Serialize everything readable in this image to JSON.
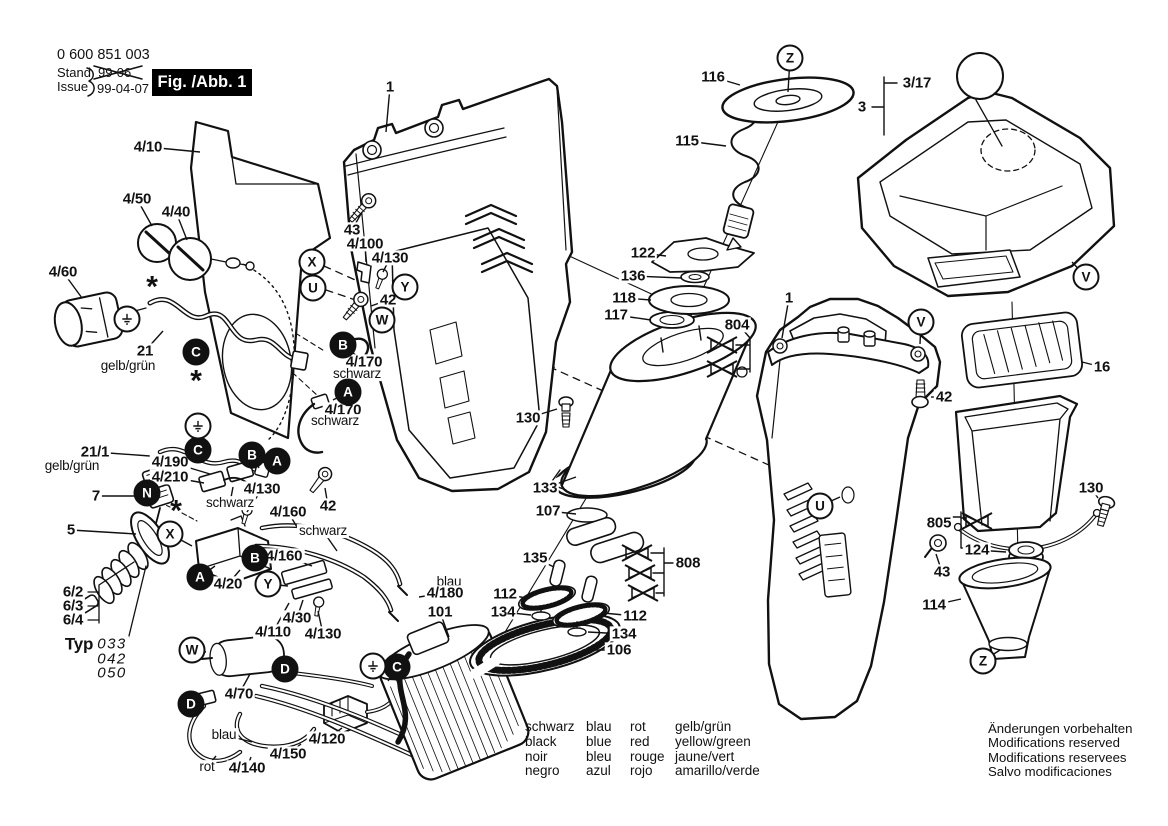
{
  "doc": {
    "part_number": "0 600 851 003",
    "stand_label": "Stand",
    "issue_label": "Issue",
    "old_issue": "99-06",
    "issue_date": "99-04-07",
    "figure_label": "Fig. /Abb. 1",
    "notice_lines": [
      "Änderungen vorbehalten",
      "Modifications reserved",
      "Modifications reservees",
      "Salvo modificaciones"
    ]
  },
  "color_legend": {
    "columns": [
      [
        "schwarz",
        "black",
        "noir",
        "negro"
      ],
      [
        "blau",
        "blue",
        "bleu",
        "azul"
      ],
      [
        "rot",
        "red",
        "rouge",
        "rojo"
      ],
      [
        "gelb/grün",
        "yellow/green",
        "jaune/vert",
        "amarillo/verde"
      ]
    ]
  },
  "colors": {
    "ink": "#111111",
    "paper": "#ffffff"
  },
  "part_labels": [
    {
      "t": "4/10",
      "x": 148,
      "y": 147,
      "tx": 200,
      "ty": 152
    },
    {
      "t": "4/50",
      "x": 137,
      "y": 199,
      "tx": 152,
      "ty": 226
    },
    {
      "t": "4/40",
      "x": 176,
      "y": 212,
      "tx": 187,
      "ty": 240
    },
    {
      "t": "4/60",
      "x": 63,
      "y": 272,
      "tx": 82,
      "ty": 298
    },
    {
      "t": "21",
      "x": 145,
      "y": 351,
      "tx": 163,
      "ty": 331
    },
    {
      "t": "gelb/grün",
      "x": 128,
      "y": 366,
      "b": 0
    },
    {
      "t": "21/1",
      "x": 95,
      "y": 452,
      "tx": 150,
      "ty": 456
    },
    {
      "t": "gelb/grün",
      "x": 72,
      "y": 466,
      "b": 0
    },
    {
      "t": "7",
      "x": 96,
      "y": 496,
      "tx": 146,
      "ty": 496
    },
    {
      "t": "5",
      "x": 71,
      "y": 530,
      "tx": 136,
      "ty": 534
    },
    {
      "t": "6/2",
      "x": 73,
      "y": 592
    },
    {
      "t": "6/3",
      "x": 73,
      "y": 606
    },
    {
      "t": "6/4",
      "x": 73,
      "y": 620
    },
    {
      "t": "Typ",
      "x": 79,
      "y": 644,
      "s": 17
    },
    {
      "t": "033",
      "x": 112,
      "y": 644,
      "i": 1
    },
    {
      "t": "042",
      "x": 112,
      "y": 659,
      "i": 1
    },
    {
      "t": "050",
      "x": 112,
      "y": 673,
      "i": 1
    },
    {
      "t": "4/190",
      "x": 170,
      "y": 462,
      "tx": 210,
      "ty": 474
    },
    {
      "t": "4/210",
      "x": 170,
      "y": 477,
      "tx": 204,
      "ty": 483
    },
    {
      "t": "schwarz",
      "x": 230,
      "y": 503,
      "b": 0,
      "tx": 233,
      "ty": 487
    },
    {
      "t": "4/130",
      "x": 262,
      "y": 489,
      "tx": 247,
      "ty": 512
    },
    {
      "t": "4/160",
      "x": 288,
      "y": 512,
      "tx": 300,
      "ty": 532
    },
    {
      "t": "schwarz",
      "x": 323,
      "y": 531,
      "b": 0,
      "tx": 337,
      "ty": 551
    },
    {
      "t": "4/160",
      "x": 284,
      "y": 556,
      "tx": 312,
      "ty": 566
    },
    {
      "t": "4/20",
      "x": 228,
      "y": 584,
      "tx": 240,
      "ty": 570
    },
    {
      "t": "4/30",
      "x": 297,
      "y": 618,
      "tx": 303,
      "ty": 600
    },
    {
      "t": "4/110",
      "x": 273,
      "y": 632,
      "tx": 289,
      "ty": 603
    },
    {
      "t": "4/130",
      "x": 323,
      "y": 634,
      "tx": 318,
      "ty": 611
    },
    {
      "t": "4/70",
      "x": 239,
      "y": 694,
      "tx": 250,
      "ty": 674
    },
    {
      "t": "blau",
      "x": 224,
      "y": 735,
      "b": 0,
      "tx": 252,
      "ty": 742
    },
    {
      "t": "4/120",
      "x": 327,
      "y": 739,
      "tx": 342,
      "ty": 728
    },
    {
      "t": "4/150",
      "x": 288,
      "y": 754,
      "tx": 301,
      "ty": 744
    },
    {
      "t": "rot",
      "x": 207,
      "y": 767,
      "b": 0,
      "tx": 216,
      "ty": 756
    },
    {
      "t": "4/140",
      "x": 247,
      "y": 768,
      "tx": 251,
      "ty": 757
    },
    {
      "t": "43",
      "x": 352,
      "y": 230,
      "tx": 362,
      "ty": 212
    },
    {
      "t": "4/100",
      "x": 365,
      "y": 244,
      "tx": 366,
      "ty": 262
    },
    {
      "t": "4/130",
      "x": 390,
      "y": 258,
      "tx": 383,
      "ty": 272
    },
    {
      "t": "42",
      "x": 388,
      "y": 300,
      "tx": 371,
      "ty": 306
    },
    {
      "t": "4/170",
      "x": 364,
      "y": 362,
      "tx": 352,
      "ty": 352
    },
    {
      "t": "schwarz",
      "x": 357,
      "y": 374,
      "b": 0
    },
    {
      "t": "4/170",
      "x": 343,
      "y": 410,
      "tx": 324,
      "ty": 403
    },
    {
      "t": "schwarz",
      "x": 335,
      "y": 421,
      "b": 0
    },
    {
      "t": "42",
      "x": 328,
      "y": 506,
      "tx": 325,
      "ty": 488
    },
    {
      "t": "1",
      "x": 390,
      "y": 87,
      "tx": 386,
      "ty": 132
    },
    {
      "t": "130",
      "x": 528,
      "y": 418,
      "tx": 557,
      "ty": 409
    },
    {
      "t": "133",
      "x": 545,
      "y": 488,
      "tx": 576,
      "ty": 477
    },
    {
      "t": "107",
      "x": 548,
      "y": 511,
      "tx": 576,
      "ty": 514
    },
    {
      "t": "135",
      "x": 535,
      "y": 558,
      "tx": 554,
      "ty": 567
    },
    {
      "t": "112",
      "x": 505,
      "y": 594,
      "tx": 526,
      "ty": 598
    },
    {
      "t": "134",
      "x": 503,
      "y": 612,
      "tx": 531,
      "ty": 615
    },
    {
      "t": "112",
      "x": 635,
      "y": 616,
      "tx": 603,
      "ty": 613
    },
    {
      "t": "134",
      "x": 624,
      "y": 634,
      "tx": 588,
      "ty": 632
    },
    {
      "t": "106",
      "x": 619,
      "y": 650,
      "tx": 594,
      "ty": 650
    },
    {
      "t": "blau",
      "x": 449,
      "y": 582,
      "b": 0
    },
    {
      "t": "4/180",
      "x": 445,
      "y": 593,
      "tx": 419,
      "ty": 597
    },
    {
      "t": "101",
      "x": 440,
      "y": 612,
      "tx": 449,
      "ty": 637
    },
    {
      "t": "808",
      "x": 688,
      "y": 563
    },
    {
      "t": "116",
      "x": 713,
      "y": 77,
      "tx": 740,
      "ty": 85
    },
    {
      "t": "115",
      "x": 687,
      "y": 141,
      "tx": 726,
      "ty": 146
    },
    {
      "t": "122",
      "x": 643,
      "y": 253,
      "tx": 666,
      "ty": 256
    },
    {
      "t": "136",
      "x": 633,
      "y": 276,
      "tx": 682,
      "ty": 278
    },
    {
      "t": "118",
      "x": 624,
      "y": 298,
      "tx": 651,
      "ty": 300
    },
    {
      "t": "117",
      "x": 616,
      "y": 315,
      "tx": 651,
      "ty": 320
    },
    {
      "t": "804",
      "x": 737,
      "y": 325
    },
    {
      "t": "1",
      "x": 789,
      "y": 298,
      "tx": 782,
      "ty": 338
    },
    {
      "t": "3/17",
      "x": 917,
      "y": 83
    },
    {
      "t": "3",
      "x": 862,
      "y": 107
    },
    {
      "t": "42",
      "x": 944,
      "y": 397,
      "tx": 931,
      "ty": 397
    },
    {
      "t": "16",
      "x": 1102,
      "y": 367,
      "tx": 1082,
      "ty": 362
    },
    {
      "t": "130",
      "x": 1091,
      "y": 488,
      "tx": 1098,
      "ty": 498
    },
    {
      "t": "805",
      "x": 939,
      "y": 523
    },
    {
      "t": "124",
      "x": 977,
      "y": 550,
      "tx": 1006,
      "ty": 552
    },
    {
      "t": "43",
      "x": 942,
      "y": 572,
      "tx": 936,
      "ty": 554
    },
    {
      "t": "114",
      "x": 934,
      "y": 605,
      "tx": 961,
      "ty": 599
    },
    {
      "t": "*",
      "x": 152,
      "y": 284,
      "a": 1
    },
    {
      "t": "*",
      "x": 196,
      "y": 378,
      "a": 1
    },
    {
      "t": "*",
      "x": 176,
      "y": 508,
      "a": 1
    }
  ],
  "callouts": [
    {
      "l": "X",
      "x": 312,
      "y": 262
    },
    {
      "l": "U",
      "x": 313,
      "y": 288
    },
    {
      "l": "Y",
      "x": 405,
      "y": 287,
      "tx": 392,
      "ty": 280
    },
    {
      "l": "W",
      "x": 382,
      "y": 320,
      "tx": 373,
      "ty": 311
    },
    {
      "l": "X",
      "x": 170,
      "y": 534,
      "tx": 192,
      "ty": 546
    },
    {
      "l": "Y",
      "x": 268,
      "y": 584,
      "tx": 288,
      "ty": 586
    },
    {
      "l": "W",
      "x": 192,
      "y": 650,
      "tx": 206,
      "ty": 652
    },
    {
      "l": "V",
      "x": 921,
      "y": 322,
      "tx": 920,
      "ty": 344
    },
    {
      "l": "V",
      "x": 1086,
      "y": 277,
      "tx": 1072,
      "ty": 262
    },
    {
      "l": "U",
      "x": 820,
      "y": 506,
      "tx": 840,
      "ty": 497
    },
    {
      "l": "Z",
      "x": 790,
      "y": 58,
      "tx": 788,
      "ty": 92
    },
    {
      "l": "Z",
      "x": 983,
      "y": 661,
      "tx": 1000,
      "ty": 650
    },
    {
      "l": "C",
      "x": 196,
      "y": 352,
      "f": 1
    },
    {
      "l": "B",
      "x": 343,
      "y": 345,
      "f": 1,
      "tx": 353,
      "ty": 350
    },
    {
      "l": "A",
      "x": 348,
      "y": 392,
      "f": 1,
      "tx": 333,
      "ty": 400
    },
    {
      "l": "C",
      "x": 198,
      "y": 450,
      "f": 1
    },
    {
      "l": "B",
      "x": 252,
      "y": 455,
      "f": 1,
      "tx": 259,
      "ty": 468
    },
    {
      "l": "A",
      "x": 277,
      "y": 461,
      "f": 1,
      "tx": 281,
      "ty": 472
    },
    {
      "l": "N",
      "x": 147,
      "y": 493,
      "f": 1
    },
    {
      "l": "B",
      "x": 255,
      "y": 558,
      "f": 1
    },
    {
      "l": "A",
      "x": 200,
      "y": 577,
      "f": 1,
      "tx": 215,
      "ty": 566
    },
    {
      "l": "D",
      "x": 285,
      "y": 669,
      "f": 1,
      "tx": 272,
      "ty": 666
    },
    {
      "l": "D",
      "x": 191,
      "y": 704,
      "f": 1,
      "tx": 203,
      "ty": 699
    },
    {
      "l": "C",
      "x": 397,
      "y": 667,
      "f": 1,
      "tx": 388,
      "ty": 681
    }
  ],
  "ground_symbols": [
    {
      "x": 127,
      "y": 319
    },
    {
      "x": 198,
      "y": 426
    },
    {
      "x": 373,
      "y": 666
    }
  ],
  "obsolete_marks": [
    {
      "x": 722,
      "y": 345
    },
    {
      "x": 722,
      "y": 369
    },
    {
      "x": 637,
      "y": 553
    },
    {
      "x": 640,
      "y": 573
    },
    {
      "x": 643,
      "y": 593
    },
    {
      "x": 977,
      "y": 521
    }
  ]
}
